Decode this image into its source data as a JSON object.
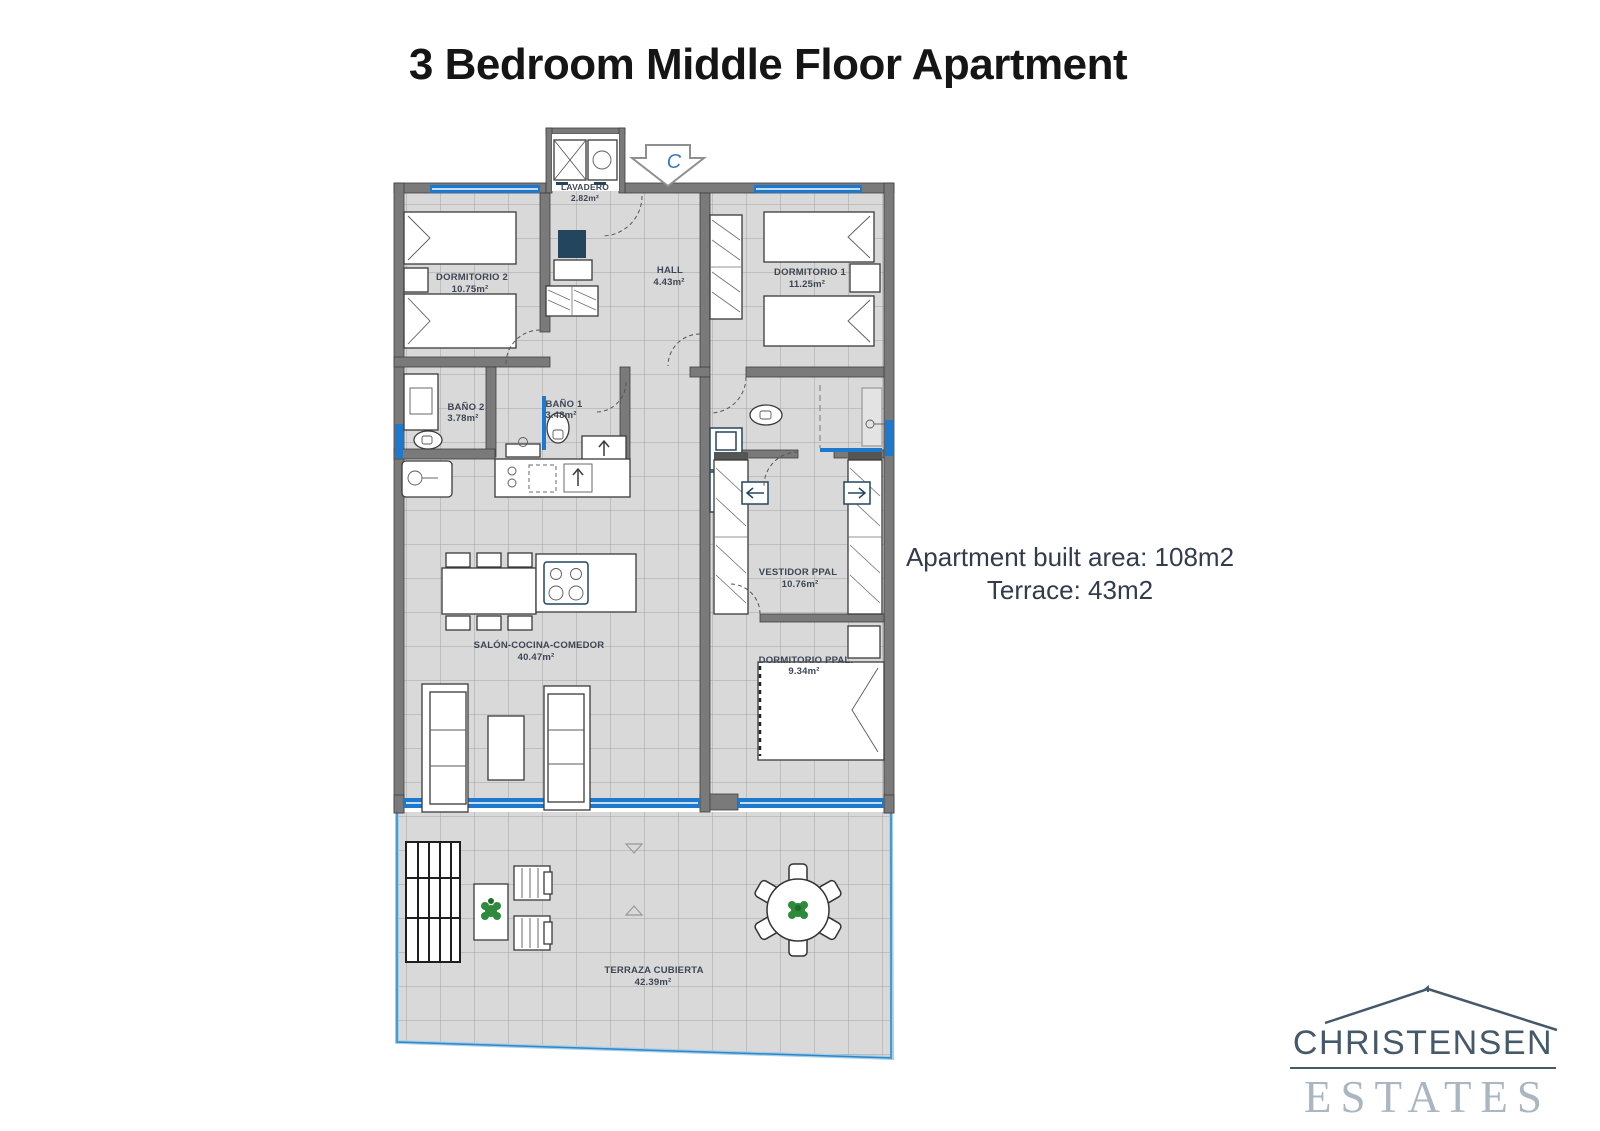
{
  "page": {
    "title": "3 Bedroom Middle Floor Apartment"
  },
  "info": {
    "line1": "Apartment built area: 108m2",
    "line2": "Terrace: 43m2"
  },
  "logo": {
    "name_top": "CHRISTENSEN",
    "name_bottom": "ESTATES"
  },
  "floor_plan": {
    "compass": "C",
    "rooms": [
      {
        "name": "LAVADERO",
        "area": "2.82m²"
      },
      {
        "name": "DORMITORIO 2",
        "area": "10.75m²"
      },
      {
        "name": "HALL",
        "area": "4.43m²"
      },
      {
        "name": "DORMITORIO 1",
        "area": "11.25m²"
      },
      {
        "name": "BAÑO 2",
        "area": "3.78m²"
      },
      {
        "name": "BAÑO 1",
        "area": "3.48m²"
      },
      {
        "name": "VESTIDOR PPAL",
        "area": "10.76m²"
      },
      {
        "name": "SALÓN-COCINA-COMEDOR",
        "area": "40.47m²"
      },
      {
        "name": "DORMITORIO PPAL.",
        "area": "9.34m²"
      },
      {
        "name": "TERRAZA CUBIERTA",
        "area": "42.39m²"
      }
    ]
  },
  "colors": {
    "window_blue": "#1d79cd",
    "wall_gray": "#7a7a7a",
    "floor_gray": "#d9d9d9",
    "label_color": "#3c4654",
    "appliance_navy": "#24455e",
    "plant_green": "#2e8b3b",
    "logo_dark": "#46596b",
    "logo_light": "#aab6c1"
  }
}
